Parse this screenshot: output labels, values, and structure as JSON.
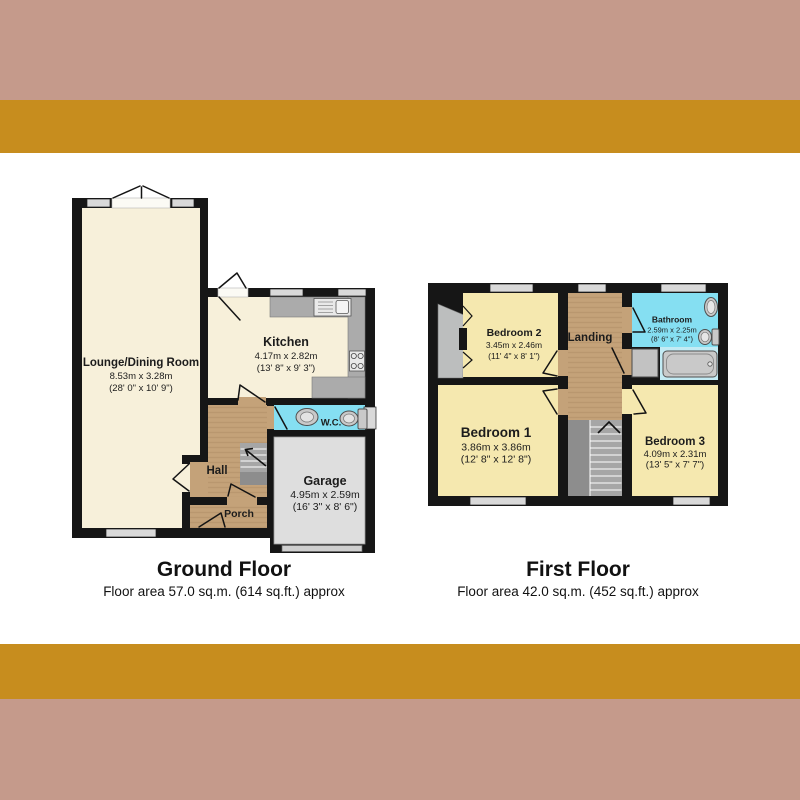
{
  "ground_floor": {
    "title": "Ground Floor",
    "area": "Floor area 57.0 sq.m. (614 sq.ft.) approx",
    "rooms": {
      "lounge": {
        "name": "Lounge/Dining Room",
        "metric": "8.53m x 3.28m",
        "imperial": "(28' 0\" x 10' 9\")"
      },
      "kitchen": {
        "name": "Kitchen",
        "metric": "4.17m x 2.82m",
        "imperial": "(13' 8\" x 9' 3\")"
      },
      "wc": {
        "name": "W.C."
      },
      "hall": {
        "name": "Hall"
      },
      "porch": {
        "name": "Porch"
      },
      "garage": {
        "name": "Garage",
        "metric": "4.95m x 2.59m",
        "imperial": "(16' 3\" x 8' 6\")"
      }
    }
  },
  "first_floor": {
    "title": "First Floor",
    "area": "Floor area 42.0 sq.m. (452 sq.ft.) approx",
    "rooms": {
      "bedroom1": {
        "name": "Bedroom 1",
        "metric": "3.86m x 3.86m",
        "imperial": "(12' 8\" x 12' 8\")"
      },
      "bedroom2": {
        "name": "Bedroom 2",
        "metric": "3.45m x 2.46m",
        "imperial": "(11' 4\" x 8' 1\")"
      },
      "bedroom3": {
        "name": "Bedroom 3",
        "metric": "4.09m x 2.31m",
        "imperial": "(13' 5\" x 7' 7\")"
      },
      "bathroom": {
        "name": "Bathroom",
        "metric": "2.59m x 2.25m",
        "imperial": "(8' 6\" x 7' 4\")"
      },
      "landing": {
        "name": "Landing"
      }
    }
  },
  "colors": {
    "page_bg": "#ffffff",
    "band_mauve": "#c59a8b",
    "band_gold": "#c78d1e",
    "wall": "#161616",
    "ground_room": "#f7f0da",
    "bedroom_yellow": "#f5e8af",
    "hall_tan": "#c4a279",
    "wet_room_cyan": "#85dff2",
    "bath_alcove": "#c3ebf4",
    "garage_gray": "#dedede",
    "closet_gray": "#bcbebe",
    "counter_gray": "#ababab",
    "window_gray": "#d9d9d9",
    "text": "#1c1c1c"
  }
}
